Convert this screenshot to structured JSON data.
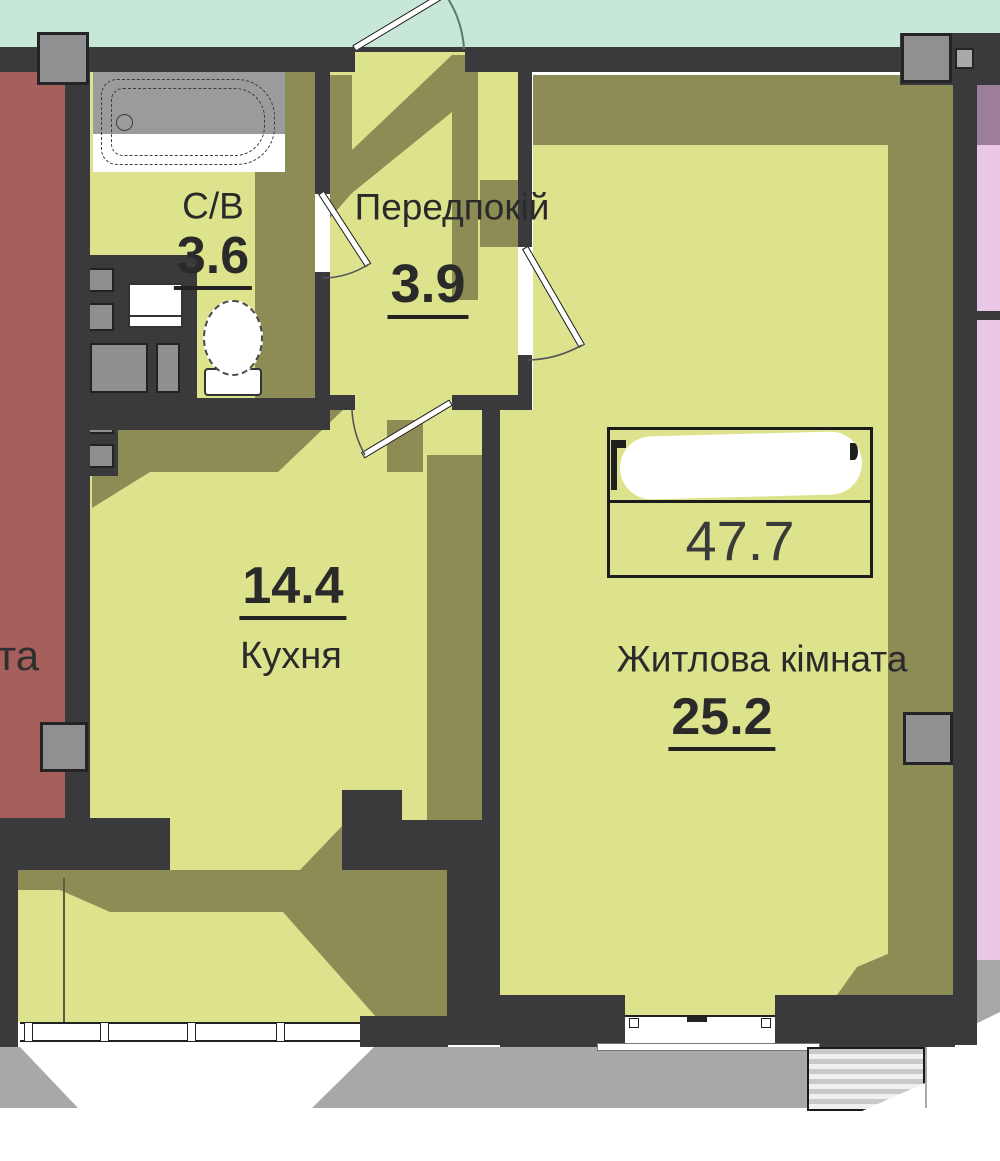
{
  "plan": {
    "rooms": [
      {
        "label": "С/В",
        "area": "3.6"
      },
      {
        "label": "Передпокій",
        "area": "3.9"
      },
      {
        "label": "Кухня",
        "area": "14.4"
      },
      {
        "label": "Житлова кімната",
        "area": "25.2"
      }
    ],
    "total_area": "47.7",
    "neighbor_fragment": "та",
    "colors": {
      "background_top": "#c7e8d6",
      "wall": "#3a3a3c",
      "room_light": "#dde28c",
      "room_shadow": "#8d8c55",
      "neighbor_left_red": "#a65f5a",
      "neighbor_right_pink": "#ebc7e7",
      "neighbor_right_mauve": "#9c7e9a",
      "column_gray": "#909092",
      "drop_shadow_gray": "#a8a8a8",
      "window_white": "#ffffff"
    }
  }
}
